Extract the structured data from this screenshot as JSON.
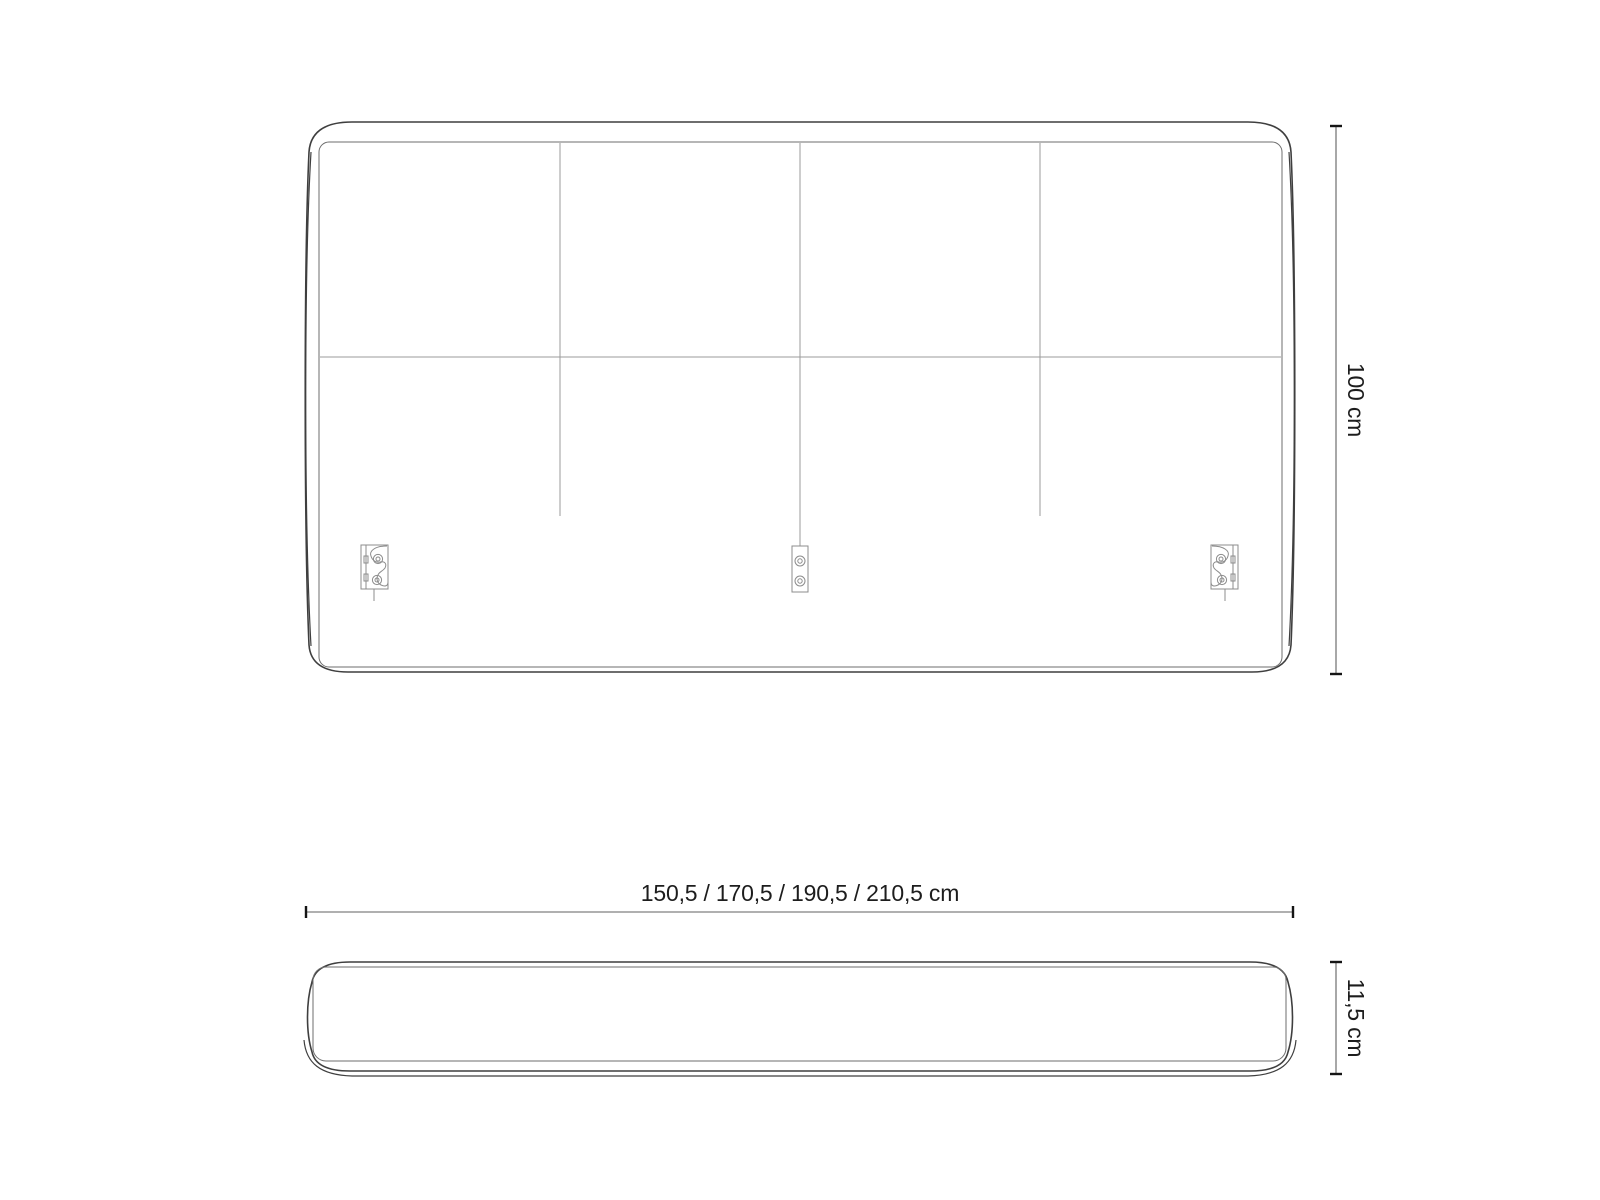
{
  "dimensions": {
    "height": {
      "label": "100 cm"
    },
    "width": {
      "label": "150,5 / 170,5 / 190,5 / 210,5 cm"
    },
    "depth": {
      "label": "11,5 cm"
    }
  },
  "colors": {
    "background": "#ffffff",
    "outline": "#3f3f3f",
    "inner_line": "#6e6e6e",
    "seam_line": "#9b9b9b",
    "bracket_line": "#8c8c8c",
    "dimension_line": "#606060",
    "dimension_tick": "#151515",
    "text": "#1d1d1d"
  }
}
